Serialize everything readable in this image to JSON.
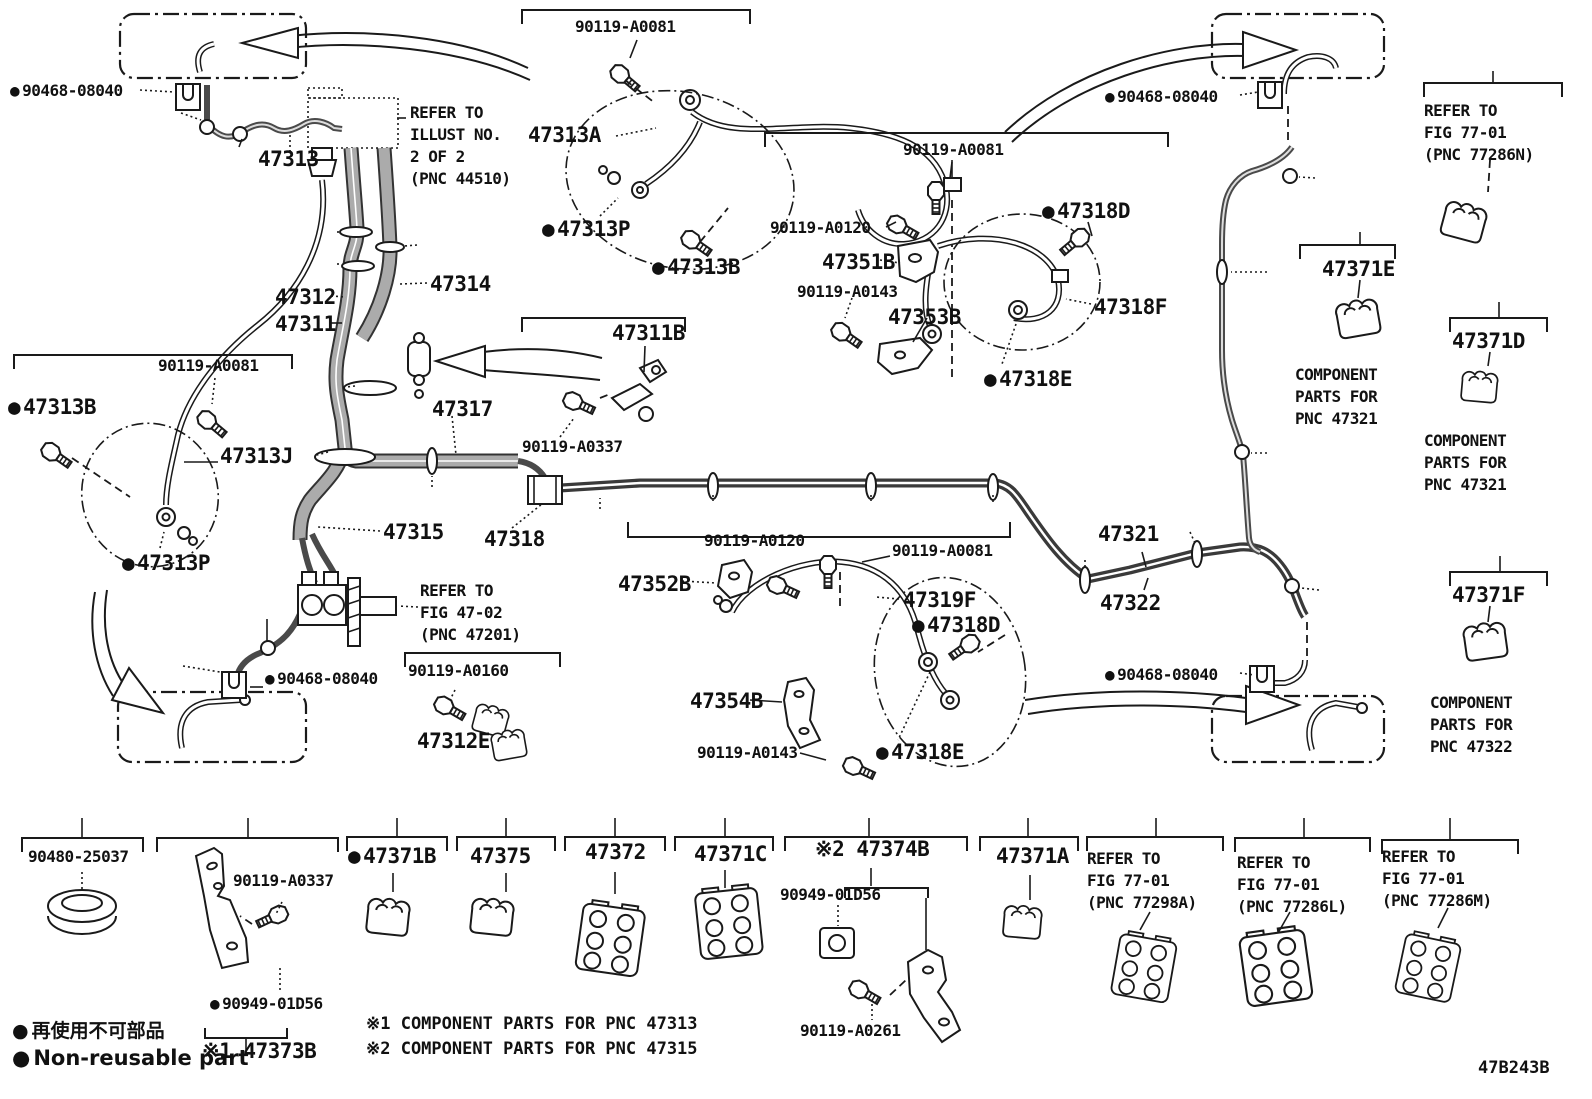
{
  "drawing_number": "47B243B",
  "legend": {
    "jp": "再使用不可部品",
    "en": "Non-reusable part",
    "bullet": "●"
  },
  "footnotes": [
    "※1 COMPONENT PARTS FOR PNC 47313",
    "※2 COMPONENT PARTS FOR PNC 47315"
  ],
  "colors": {
    "ink": "#1a1a1a",
    "pipe_outer": "#333333",
    "pipe_inner": "#ababab",
    "background": "#ffffff"
  },
  "labels": [
    {
      "id": "90468-08040-tl",
      "t": "90468-08040",
      "x": 10,
      "y": 82,
      "s": "md",
      "b": 1
    },
    {
      "id": "47313",
      "t": "47313",
      "x": 258,
      "y": 148,
      "s": "lg"
    },
    {
      "id": "ref-44510",
      "lines": [
        "REFER TO",
        "ILLUST NO.",
        "2 OF 2",
        "(PNC 44510)"
      ],
      "x": 410,
      "y": 102,
      "s": "md"
    },
    {
      "id": "90119-A0081-top",
      "t": "90119-A0081",
      "x": 575,
      "y": 18,
      "s": "md"
    },
    {
      "id": "47313A",
      "t": "47313A",
      "x": 528,
      "y": 124,
      "s": "lg"
    },
    {
      "id": "47313P-top",
      "t": "47313P",
      "x": 542,
      "y": 218,
      "s": "lg",
      "b": 1
    },
    {
      "id": "47313B-top",
      "t": "47313B",
      "x": 652,
      "y": 256,
      "s": "lg",
      "b": 1
    },
    {
      "id": "90119-A0081-r",
      "t": "90119-A0081",
      "x": 903,
      "y": 141,
      "s": "md"
    },
    {
      "id": "90119-A0120-t",
      "t": "90119-A0120",
      "x": 770,
      "y": 219,
      "s": "md"
    },
    {
      "id": "47351B",
      "t": "47351B",
      "x": 822,
      "y": 251,
      "s": "lg"
    },
    {
      "id": "90119-A0143-t",
      "t": "90119-A0143",
      "x": 797,
      "y": 283,
      "s": "md"
    },
    {
      "id": "47353B",
      "t": "47353B",
      "x": 888,
      "y": 306,
      "s": "lg"
    },
    {
      "id": "47318D-t",
      "t": "47318D",
      "x": 1042,
      "y": 200,
      "s": "lg",
      "b": 1
    },
    {
      "id": "47318F",
      "t": "47318F",
      "x": 1094,
      "y": 296,
      "s": "lg"
    },
    {
      "id": "47318E-t",
      "t": "47318E",
      "x": 984,
      "y": 368,
      "s": "lg",
      "b": 1
    },
    {
      "id": "90468-08040-tr",
      "t": "90468-08040",
      "x": 1105,
      "y": 88,
      "s": "md",
      "b": 1
    },
    {
      "id": "ref-77286N",
      "lines": [
        "REFER TO",
        "FIG 77-01",
        "(PNC 77286N)"
      ],
      "x": 1424,
      "y": 100,
      "s": "md"
    },
    {
      "id": "47371E",
      "t": "47371E",
      "x": 1322,
      "y": 258,
      "s": "lg"
    },
    {
      "id": "comp-47321-a",
      "lines": [
        "COMPONENT",
        "PARTS FOR",
        "PNC 47321"
      ],
      "x": 1295,
      "y": 364,
      "s": "md"
    },
    {
      "id": "47371D",
      "t": "47371D",
      "x": 1452,
      "y": 330,
      "s": "lg"
    },
    {
      "id": "comp-47321-b",
      "lines": [
        "COMPONENT",
        "PARTS FOR",
        "PNC 47321"
      ],
      "x": 1424,
      "y": 430,
      "s": "md"
    },
    {
      "id": "47371F",
      "t": "47371F",
      "x": 1452,
      "y": 584,
      "s": "lg"
    },
    {
      "id": "comp-47322",
      "lines": [
        "COMPONENT",
        "PARTS FOR",
        "PNC 47322"
      ],
      "x": 1430,
      "y": 692,
      "s": "md"
    },
    {
      "id": "90119-A0081-l",
      "t": "90119-A0081",
      "x": 158,
      "y": 357,
      "s": "md"
    },
    {
      "id": "47313B-l",
      "t": "47313B",
      "x": 8,
      "y": 396,
      "s": "lg",
      "b": 1
    },
    {
      "id": "47313J",
      "t": "47313J",
      "x": 220,
      "y": 445,
      "s": "lg"
    },
    {
      "id": "47313P-l",
      "t": "47313P",
      "x": 122,
      "y": 552,
      "s": "lg",
      "b": 1
    },
    {
      "id": "47312",
      "t": "47312",
      "x": 275,
      "y": 286,
      "s": "lg"
    },
    {
      "id": "47311",
      "t": "47311",
      "x": 275,
      "y": 313,
      "s": "lg"
    },
    {
      "id": "47314",
      "t": "47314",
      "x": 430,
      "y": 273,
      "s": "lg"
    },
    {
      "id": "47311B",
      "t": "47311B",
      "x": 612,
      "y": 322,
      "s": "lg"
    },
    {
      "id": "90119-A0337-c",
      "t": "90119-A0337",
      "x": 522,
      "y": 438,
      "s": "md"
    },
    {
      "id": "47317",
      "t": "47317",
      "x": 432,
      "y": 398,
      "s": "lg"
    },
    {
      "id": "47315",
      "t": "47315",
      "x": 383,
      "y": 521,
      "s": "lg"
    },
    {
      "id": "47318",
      "t": "47318",
      "x": 484,
      "y": 528,
      "s": "lg"
    },
    {
      "id": "90119-A0120-c",
      "t": "90119-A0120",
      "x": 704,
      "y": 532,
      "s": "md"
    },
    {
      "id": "90119-A0081-c",
      "t": "90119-A0081",
      "x": 892,
      "y": 542,
      "s": "md"
    },
    {
      "id": "ref-47201",
      "lines": [
        "REFER TO",
        "FIG 47-02",
        "(PNC 47201)"
      ],
      "x": 420,
      "y": 580,
      "s": "md"
    },
    {
      "id": "90119-A0160",
      "t": "90119-A0160",
      "x": 408,
      "y": 662,
      "s": "md"
    },
    {
      "id": "47312E",
      "t": "47312E",
      "x": 417,
      "y": 730,
      "s": "lg"
    },
    {
      "id": "90468-08040-c",
      "t": "90468-08040",
      "x": 265,
      "y": 670,
      "s": "md",
      "b": 1
    },
    {
      "id": "47352B",
      "t": "47352B",
      "x": 618,
      "y": 573,
      "s": "lg"
    },
    {
      "id": "47319F",
      "t": "47319F",
      "x": 903,
      "y": 589,
      "s": "lg"
    },
    {
      "id": "47318D-b",
      "t": "47318D",
      "x": 912,
      "y": 614,
      "s": "lg",
      "b": 1
    },
    {
      "id": "47354B",
      "t": "47354B",
      "x": 690,
      "y": 690,
      "s": "lg"
    },
    {
      "id": "90119-A0143-b",
      "t": "90119-A0143",
      "x": 697,
      "y": 744,
      "s": "md"
    },
    {
      "id": "47318E-b",
      "t": "47318E",
      "x": 876,
      "y": 741,
      "s": "lg",
      "b": 1
    },
    {
      "id": "47321",
      "t": "47321",
      "x": 1098,
      "y": 523,
      "s": "lg"
    },
    {
      "id": "47322",
      "t": "47322",
      "x": 1100,
      "y": 592,
      "s": "lg"
    },
    {
      "id": "90468-08040-br",
      "t": "90468-08040",
      "x": 1105,
      "y": 666,
      "s": "md",
      "b": 1
    },
    {
      "id": "90480-25037",
      "t": "90480-25037",
      "x": 28,
      "y": 848,
      "s": "md"
    },
    {
      "id": "90119-A0337-b",
      "t": "90119-A0337",
      "x": 233,
      "y": 872,
      "s": "md"
    },
    {
      "id": "90949-01D56-2",
      "t": "90949-01D56",
      "x": 210,
      "y": 995,
      "s": "md",
      "b": 1
    },
    {
      "id": "47373B",
      "t": "※1 47373B",
      "x": 202,
      "y": 1040,
      "s": "lg"
    },
    {
      "id": "47371B",
      "t": "47371B",
      "x": 348,
      "y": 845,
      "s": "lg",
      "b": 1
    },
    {
      "id": "47375",
      "t": "47375",
      "x": 470,
      "y": 845,
      "s": "lg"
    },
    {
      "id": "47372",
      "t": "47372",
      "x": 585,
      "y": 841,
      "s": "lg"
    },
    {
      "id": "47371C",
      "t": "47371C",
      "x": 694,
      "y": 843,
      "s": "lg"
    },
    {
      "id": "47374B",
      "t": "※2 47374B",
      "x": 815,
      "y": 838,
      "s": "lg"
    },
    {
      "id": "90949-01D56-7",
      "t": "90949-01D56",
      "x": 780,
      "y": 886,
      "s": "md"
    },
    {
      "id": "90119-A0261",
      "t": "90119-A0261",
      "x": 800,
      "y": 1022,
      "s": "md"
    },
    {
      "id": "47371A",
      "t": "47371A",
      "x": 996,
      "y": 845,
      "s": "lg"
    },
    {
      "id": "ref-77298A",
      "lines": [
        "REFER TO",
        "FIG 77-01",
        "(PNC 77298A)"
      ],
      "x": 1087,
      "y": 848,
      "s": "md"
    },
    {
      "id": "ref-77286L",
      "lines": [
        "REFER TO",
        "FIG 77-01",
        "(PNC 77286L)"
      ],
      "x": 1237,
      "y": 852,
      "s": "md"
    },
    {
      "id": "ref-77286M",
      "lines": [
        "REFER TO",
        "FIG 77-01",
        "(PNC 77286M)"
      ],
      "x": 1382,
      "y": 846,
      "s": "md"
    }
  ],
  "callouts": [
    {
      "n": "1",
      "x": 163,
      "y": 113
    },
    {
      "n": "2",
      "x": 232,
      "y": 165
    },
    {
      "n": "3",
      "x": 319,
      "y": 232
    },
    {
      "n": "4",
      "x": 319,
      "y": 264
    },
    {
      "n": "5",
      "x": 435,
      "y": 245
    },
    {
      "n": "5",
      "x": 337,
      "y": 386
    },
    {
      "n": "6",
      "x": 310,
      "y": 452
    },
    {
      "n": "8",
      "x": 432,
      "y": 505
    },
    {
      "n": "9",
      "x": 600,
      "y": 527
    },
    {
      "n": "7",
      "x": 267,
      "y": 601
    },
    {
      "n": "1",
      "x": 165,
      "y": 666
    },
    {
      "n": "10",
      "x": 713,
      "y": 477
    },
    {
      "n": "10",
      "x": 871,
      "y": 477
    },
    {
      "n": "10",
      "x": 993,
      "y": 477
    },
    {
      "n": "11",
      "x": 1085,
      "y": 542
    },
    {
      "n": "11",
      "x": 1190,
      "y": 514
    },
    {
      "n": "12",
      "x": 1333,
      "y": 178
    },
    {
      "n": "14",
      "x": 1285,
      "y": 272
    },
    {
      "n": "13",
      "x": 1285,
      "y": 453
    },
    {
      "n": "15",
      "x": 1337,
      "y": 590
    },
    {
      "n": "13",
      "x": 1493,
      "y": 53
    },
    {
      "n": "12",
      "x": 1360,
      "y": 214
    },
    {
      "n": "14",
      "x": 1499,
      "y": 284
    },
    {
      "n": "15",
      "x": 1500,
      "y": 538
    },
    {
      "n": "1",
      "x": 82,
      "y": 800
    },
    {
      "n": "2",
      "x": 248,
      "y": 800
    },
    {
      "n": "3",
      "x": 397,
      "y": 800
    },
    {
      "n": "4",
      "x": 506,
      "y": 800
    },
    {
      "n": "5",
      "x": 615,
      "y": 800
    },
    {
      "n": "6",
      "x": 725,
      "y": 800
    },
    {
      "n": "7",
      "x": 869,
      "y": 800
    },
    {
      "n": "8",
      "x": 1028,
      "y": 800
    },
    {
      "n": "9",
      "x": 1156,
      "y": 800
    },
    {
      "n": "10",
      "x": 1304,
      "y": 800
    },
    {
      "n": "11",
      "x": 1450,
      "y": 800
    }
  ]
}
